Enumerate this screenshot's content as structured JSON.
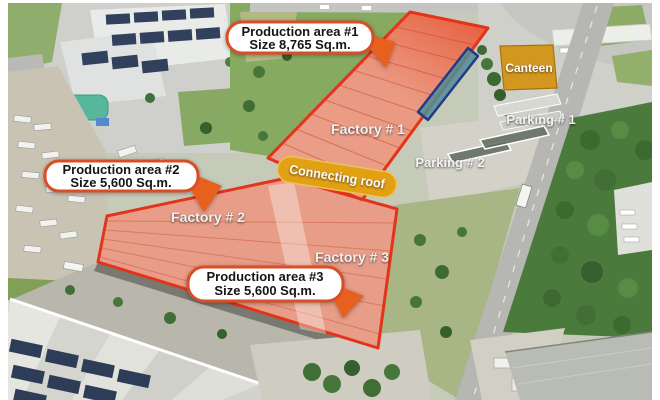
{
  "photo": {
    "description": "Aerial view of industrial estate with annotated factory buildings",
    "callouts": [
      {
        "title": "Production area #1",
        "size": "Size 8,765 Sq.m."
      },
      {
        "title": "Production area #2",
        "size": "Size 5,600 Sq.m."
      },
      {
        "title": "Production area #3",
        "size": "Size 5,600 Sq.m."
      }
    ],
    "area_labels": {
      "factory1": "Factory # 1",
      "factory2": "Factory # 2",
      "factory3": "Factory # 3",
      "connecting_roof": "Connecting roof",
      "canteen": "Canteen",
      "parking1": "Parking # 1",
      "parking2": "Parking # 2"
    },
    "colors": {
      "highlight_fill": "#ef8063",
      "highlight_border": "#e3331a",
      "callout_border": "#d94e26",
      "callout_arrow": "#e8601e",
      "banner_fill": "#e2a013",
      "canteen_fill": "#d29110",
      "teal_strip_fill": "#4f8e96",
      "teal_strip_border": "#253a85"
    }
  }
}
